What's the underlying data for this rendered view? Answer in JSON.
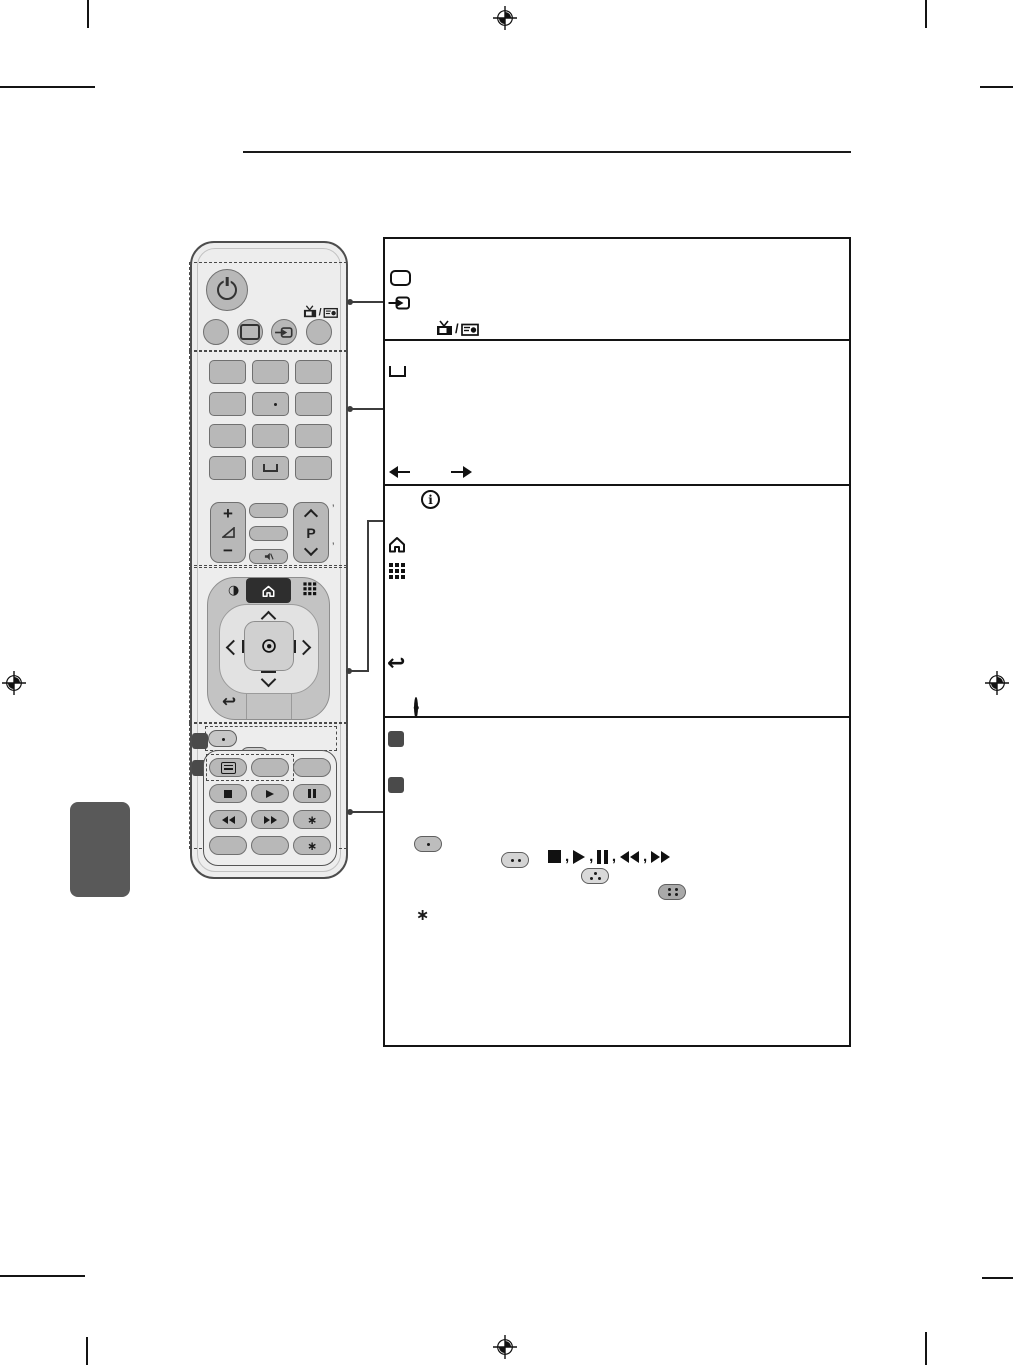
{
  "document": {
    "kind": "tv-remote-manual-page",
    "layout": "remote illustration left, four description boxes right"
  },
  "labels": {
    "plus": "+",
    "minus": "−",
    "program": "P",
    "info_i": "i",
    "half_circle": "◑",
    "back": "↩",
    "comma": ",",
    "slash": "/",
    "asterisk": "∗",
    "tick": "’"
  },
  "colors": {
    "page": "#ffffff",
    "box_border": "#141414",
    "dashed_outline": "#4a4a4a",
    "remote_body": "#ededed",
    "button_gray": "#b8b8b8",
    "nav_outer": "#c3c3c3",
    "nav_inner": "#e2e2e2",
    "center_button": "#d0d0d0",
    "dark_button": "#2e2e2e",
    "side_tab": "#595959",
    "callout_line": "#3d3d3d"
  },
  "remote": {
    "sections": [
      {
        "name": "power-source",
        "buttons": [
          "power",
          "blank",
          "tv",
          "input",
          "tv-radio"
        ]
      },
      {
        "name": "number-pad",
        "buttons": [
          "digits 4x3 grid",
          "dot on center key",
          "space key"
        ]
      },
      {
        "name": "volume-program",
        "buttons": [
          "volume up/down rocker",
          "three small keys",
          "mute",
          "programme up/down rocker"
        ]
      },
      {
        "name": "navigation",
        "buttons": [
          "quick-menu",
          "home",
          "apps-grid",
          "up",
          "left",
          "ok",
          "right",
          "down",
          "back"
        ]
      },
      {
        "name": "color-playback",
        "buttons": [
          "red",
          "green",
          "yellow",
          "blue",
          "text",
          "stop",
          "play",
          "pause",
          "rewind",
          "fast-forward",
          "asterisk-1",
          "asterisk-2"
        ]
      }
    ]
  },
  "boxes": [
    {
      "id": "box-1",
      "topic": "power-source",
      "icons": [
        "tv-outline",
        "input-arrow",
        "tv-filled",
        "radio"
      ]
    },
    {
      "id": "box-2",
      "topic": "number-pad",
      "icons": [
        "space-glyph",
        "arrow-left",
        "arrow-right"
      ]
    },
    {
      "id": "box-3",
      "topic": "navigation",
      "icons": [
        "info",
        "home",
        "apps-grid",
        "ok-dot",
        "back-arrow"
      ]
    },
    {
      "id": "box-4",
      "topic": "color-playback",
      "icons": [
        "marker-1",
        "color-buttons",
        "marker-2",
        "playback-sequence",
        "asterisk-note"
      ]
    }
  ],
  "color_buttons": [
    {
      "name": "red",
      "dots": 1
    },
    {
      "name": "green",
      "dots": 2
    },
    {
      "name": "yellow",
      "dots": 3
    },
    {
      "name": "blue",
      "dots": 4
    }
  ],
  "playback_sequence": [
    "stop",
    "play",
    "pause",
    "rewind",
    "fast-forward"
  ]
}
